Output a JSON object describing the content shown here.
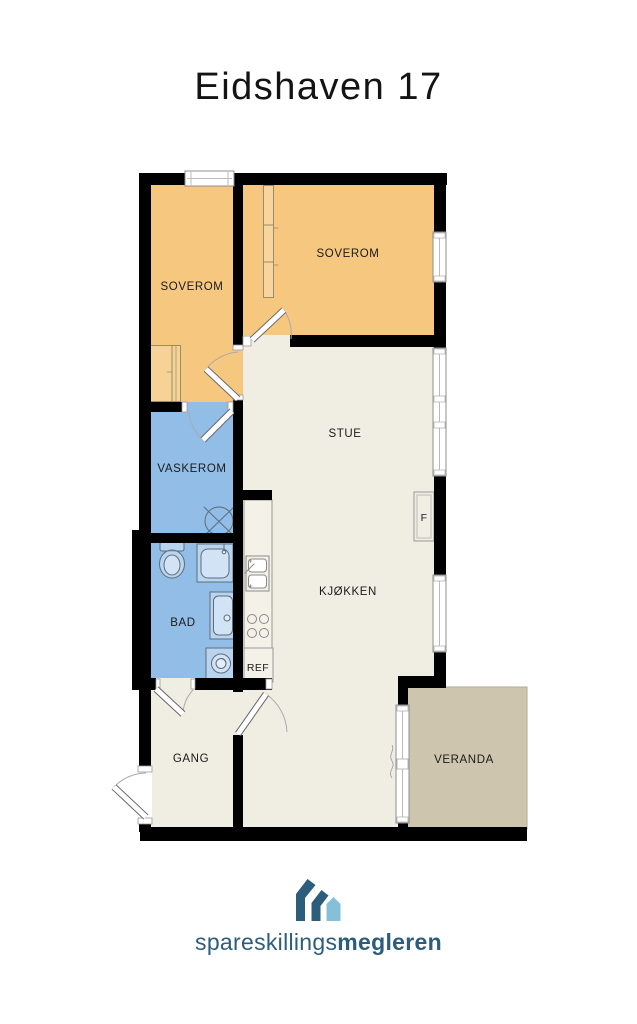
{
  "title": "Eidshaven 17",
  "floor_plan": {
    "rooms": {
      "soverom_left": "SOVEROM",
      "soverom_right": "SOVEROM",
      "stue": "STUE",
      "vaskerom": "VASKEROM",
      "bad": "BAD",
      "kjokken": "KJØKKEN",
      "gang": "GANG",
      "veranda": "VERANDA"
    },
    "annotations": {
      "refrigerator": "REF",
      "fireplace": "F"
    }
  },
  "logo": {
    "name_regular": "spareskillings",
    "name_bold": "megleren"
  },
  "colors": {
    "bedroom_orange": "#F6C77E",
    "wet_room_blue": "#92BDE7",
    "floor_cream": "#F0EDE3",
    "veranda_tan": "#CEC5AE",
    "wall_black": "#000000",
    "logo_dark_blue": "#2C5D7B",
    "logo_light_blue": "#85C0D8"
  }
}
